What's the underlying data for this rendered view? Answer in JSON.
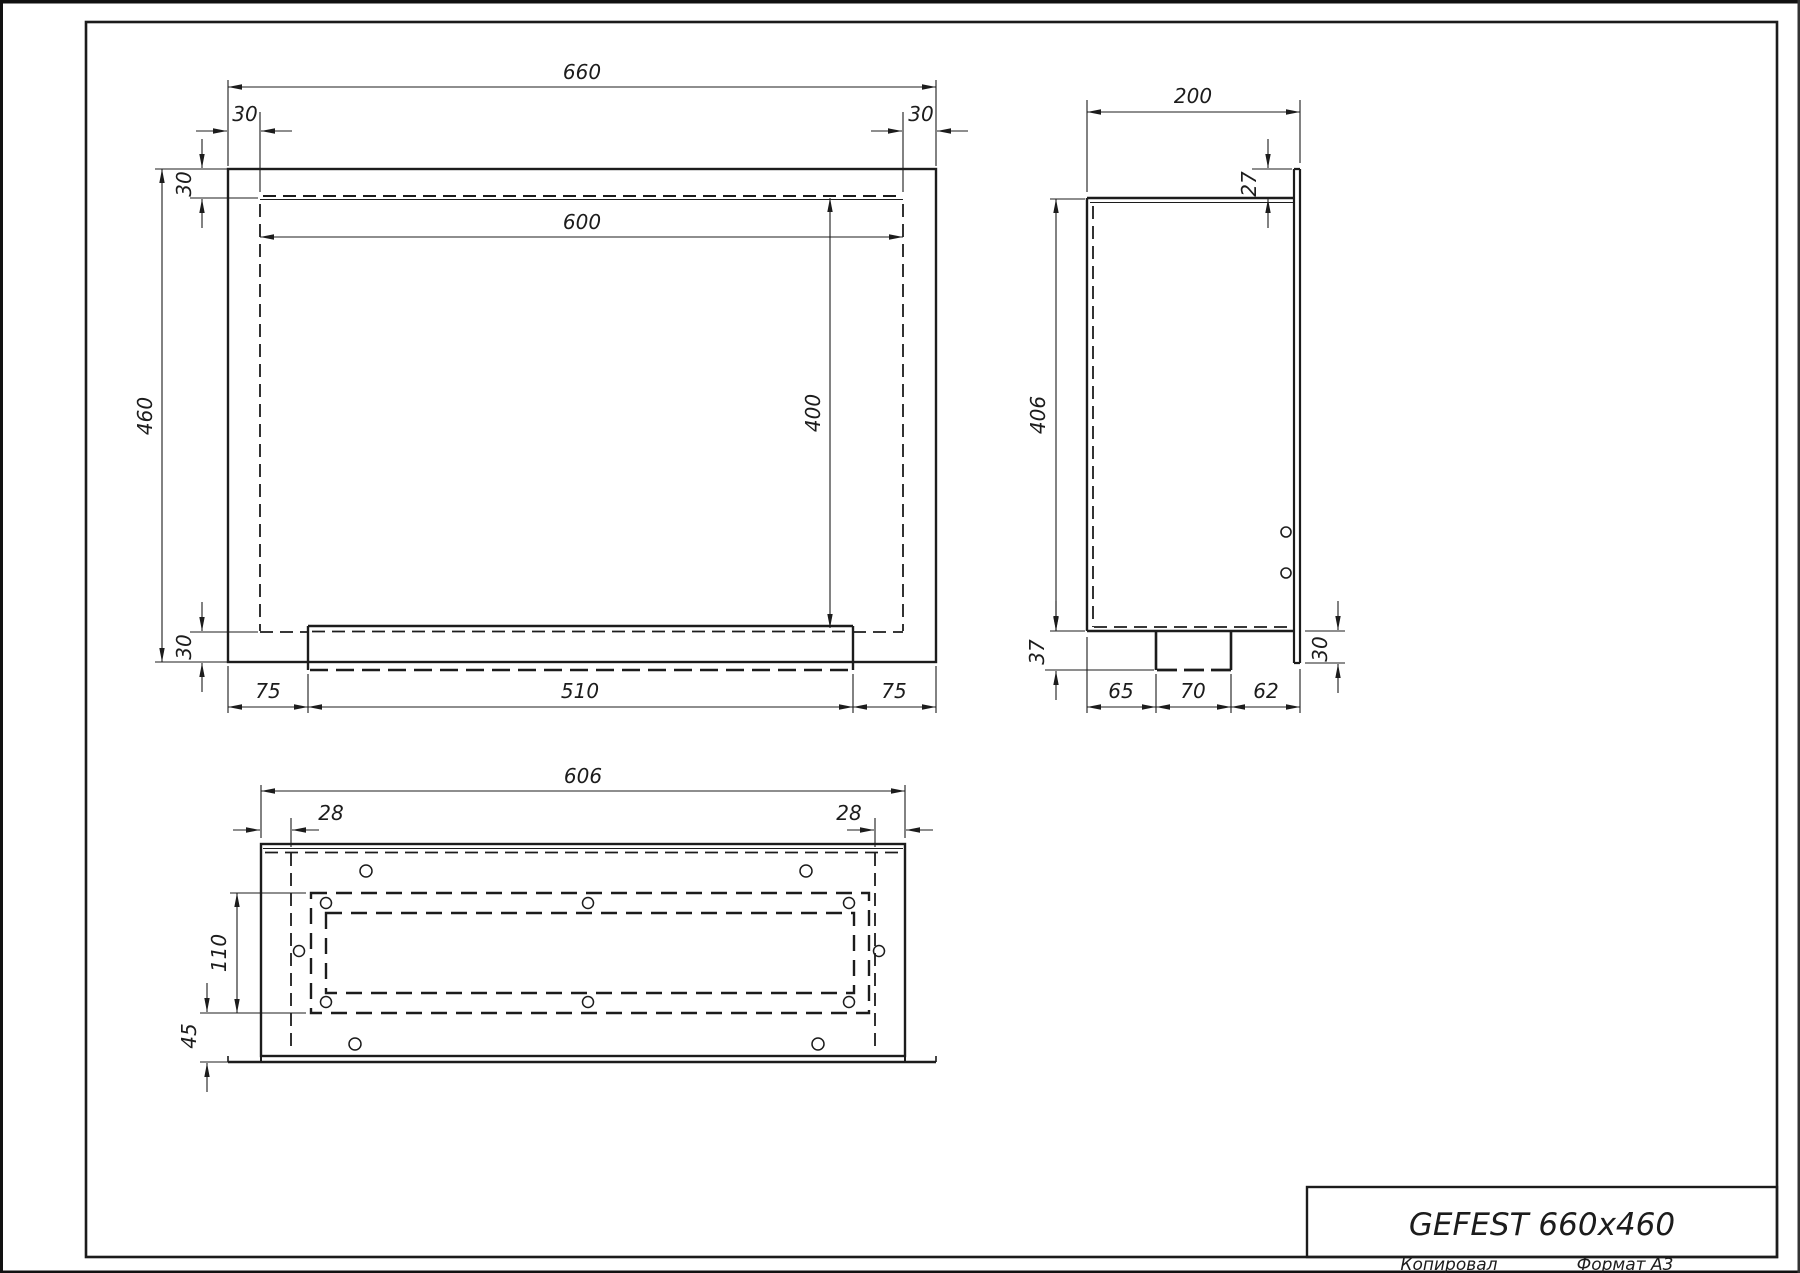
{
  "title_block": {
    "model": "GEFEST 660x460",
    "footer_left": "Копировал",
    "footer_right": "Формат А3"
  },
  "colors": {
    "ink": "#1c1c1c",
    "paper": "#ffffff"
  },
  "front_view": {
    "dims": {
      "overall_width": "660",
      "flange_left": "30",
      "flange_right": "30",
      "flange_top": "30",
      "overall_height": "460",
      "opening_width": "600",
      "opening_height": "400",
      "flange_bottom": "30",
      "tray_left_margin": "75",
      "tray_width": "510",
      "tray_right_margin": "75"
    }
  },
  "side_view": {
    "dims": {
      "depth": "200",
      "front_lip_top": "27",
      "body_height": "406",
      "duct_depth": "37",
      "duct_offset_left": "65",
      "duct_width": "70",
      "duct_offset_right": "62",
      "front_lip_bottom": "30"
    }
  },
  "bottom_view": {
    "dims": {
      "body_width": "606",
      "bend_left": "28",
      "bend_right": "28",
      "opening_depth": "110",
      "flange_offset": "45"
    }
  }
}
